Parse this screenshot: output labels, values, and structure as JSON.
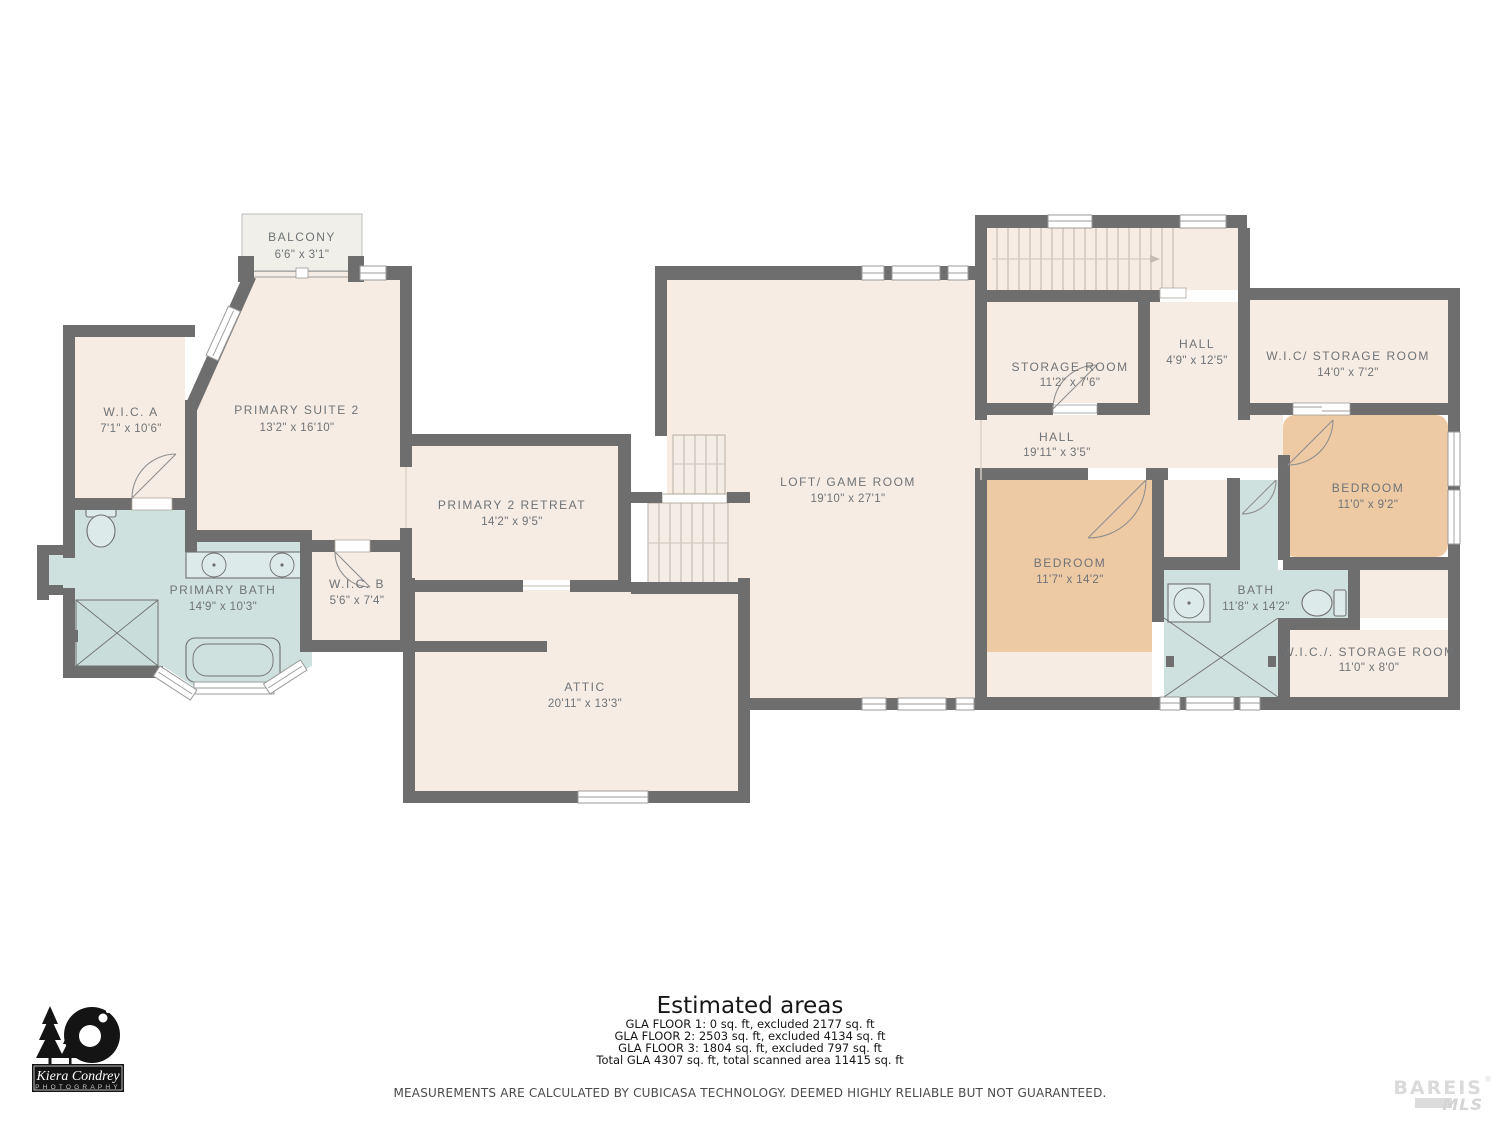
{
  "plan": {
    "rooms": [
      {
        "name": "BALCONY",
        "dims": "6'6\" x 3'1\""
      },
      {
        "name": "W.I.C. A",
        "dims": "7'1\" x 10'6\""
      },
      {
        "name": "PRIMARY SUITE 2",
        "dims": "13'2\" x 16'10\""
      },
      {
        "name": "PRIMARY BATH",
        "dims": "14'9\" x 10'3\""
      },
      {
        "name": "W.I.C. B",
        "dims": "5'6\" x 7'4\""
      },
      {
        "name": "PRIMARY 2 RETREAT",
        "dims": "14'2\" x 9'5\""
      },
      {
        "name": "ATTIC",
        "dims": "20'11\" x 13'3\""
      },
      {
        "name": "LOFT/ GAME ROOM",
        "dims": "19'10\" x 27'1\""
      },
      {
        "name": "STORAGE ROOM",
        "dims": "11'2\" x 7'6\""
      },
      {
        "name": "HALL",
        "dims": "4'9\" x 12'5\""
      },
      {
        "name": "W.I.C/ STORAGE ROOM",
        "dims": "14'0\" x 7'2\""
      },
      {
        "name": "HALL",
        "dims": "19'11\" x 3'5\""
      },
      {
        "name": "BEDROOM",
        "dims": "11'7\" x 14'2\""
      },
      {
        "name": "BEDROOM",
        "dims": "11'0\" x 9'2\""
      },
      {
        "name": "BATH",
        "dims": "11'8\" x 14'2\""
      },
      {
        "name": "W.I.C./. STORAGE ROOM",
        "dims": "11'0\" x 8'0\""
      }
    ],
    "colors": {
      "wall": "#6e6e6e",
      "room": "#f7ece4",
      "bath": "#cfe1df",
      "bedroom": "#eecaa4",
      "label": "#6f7377"
    }
  },
  "footer": {
    "title": "Estimated areas",
    "lines": [
      "GLA FLOOR 1: 0 sq. ft, excluded 2177 sq. ft",
      "GLA FLOOR 2: 2503 sq. ft, excluded 4134 sq. ft",
      "GLA FLOOR 3: 1804 sq. ft, excluded 797 sq. ft",
      "Total GLA 4307 sq. ft, total scanned area 11415 sq. ft"
    ],
    "disclaimer": "MEASUREMENTS ARE CALCULATED BY CUBICASA TECHNOLOGY. DEEMED HIGHLY RELIABLE BUT NOT GUARANTEED."
  },
  "logos": {
    "photography": {
      "name": "Kiera Condrey",
      "subtitle": "PHOTOGRAPHY"
    },
    "mls": {
      "name": "BAREIS",
      "registered": "®",
      "suffix": "MLS"
    }
  }
}
